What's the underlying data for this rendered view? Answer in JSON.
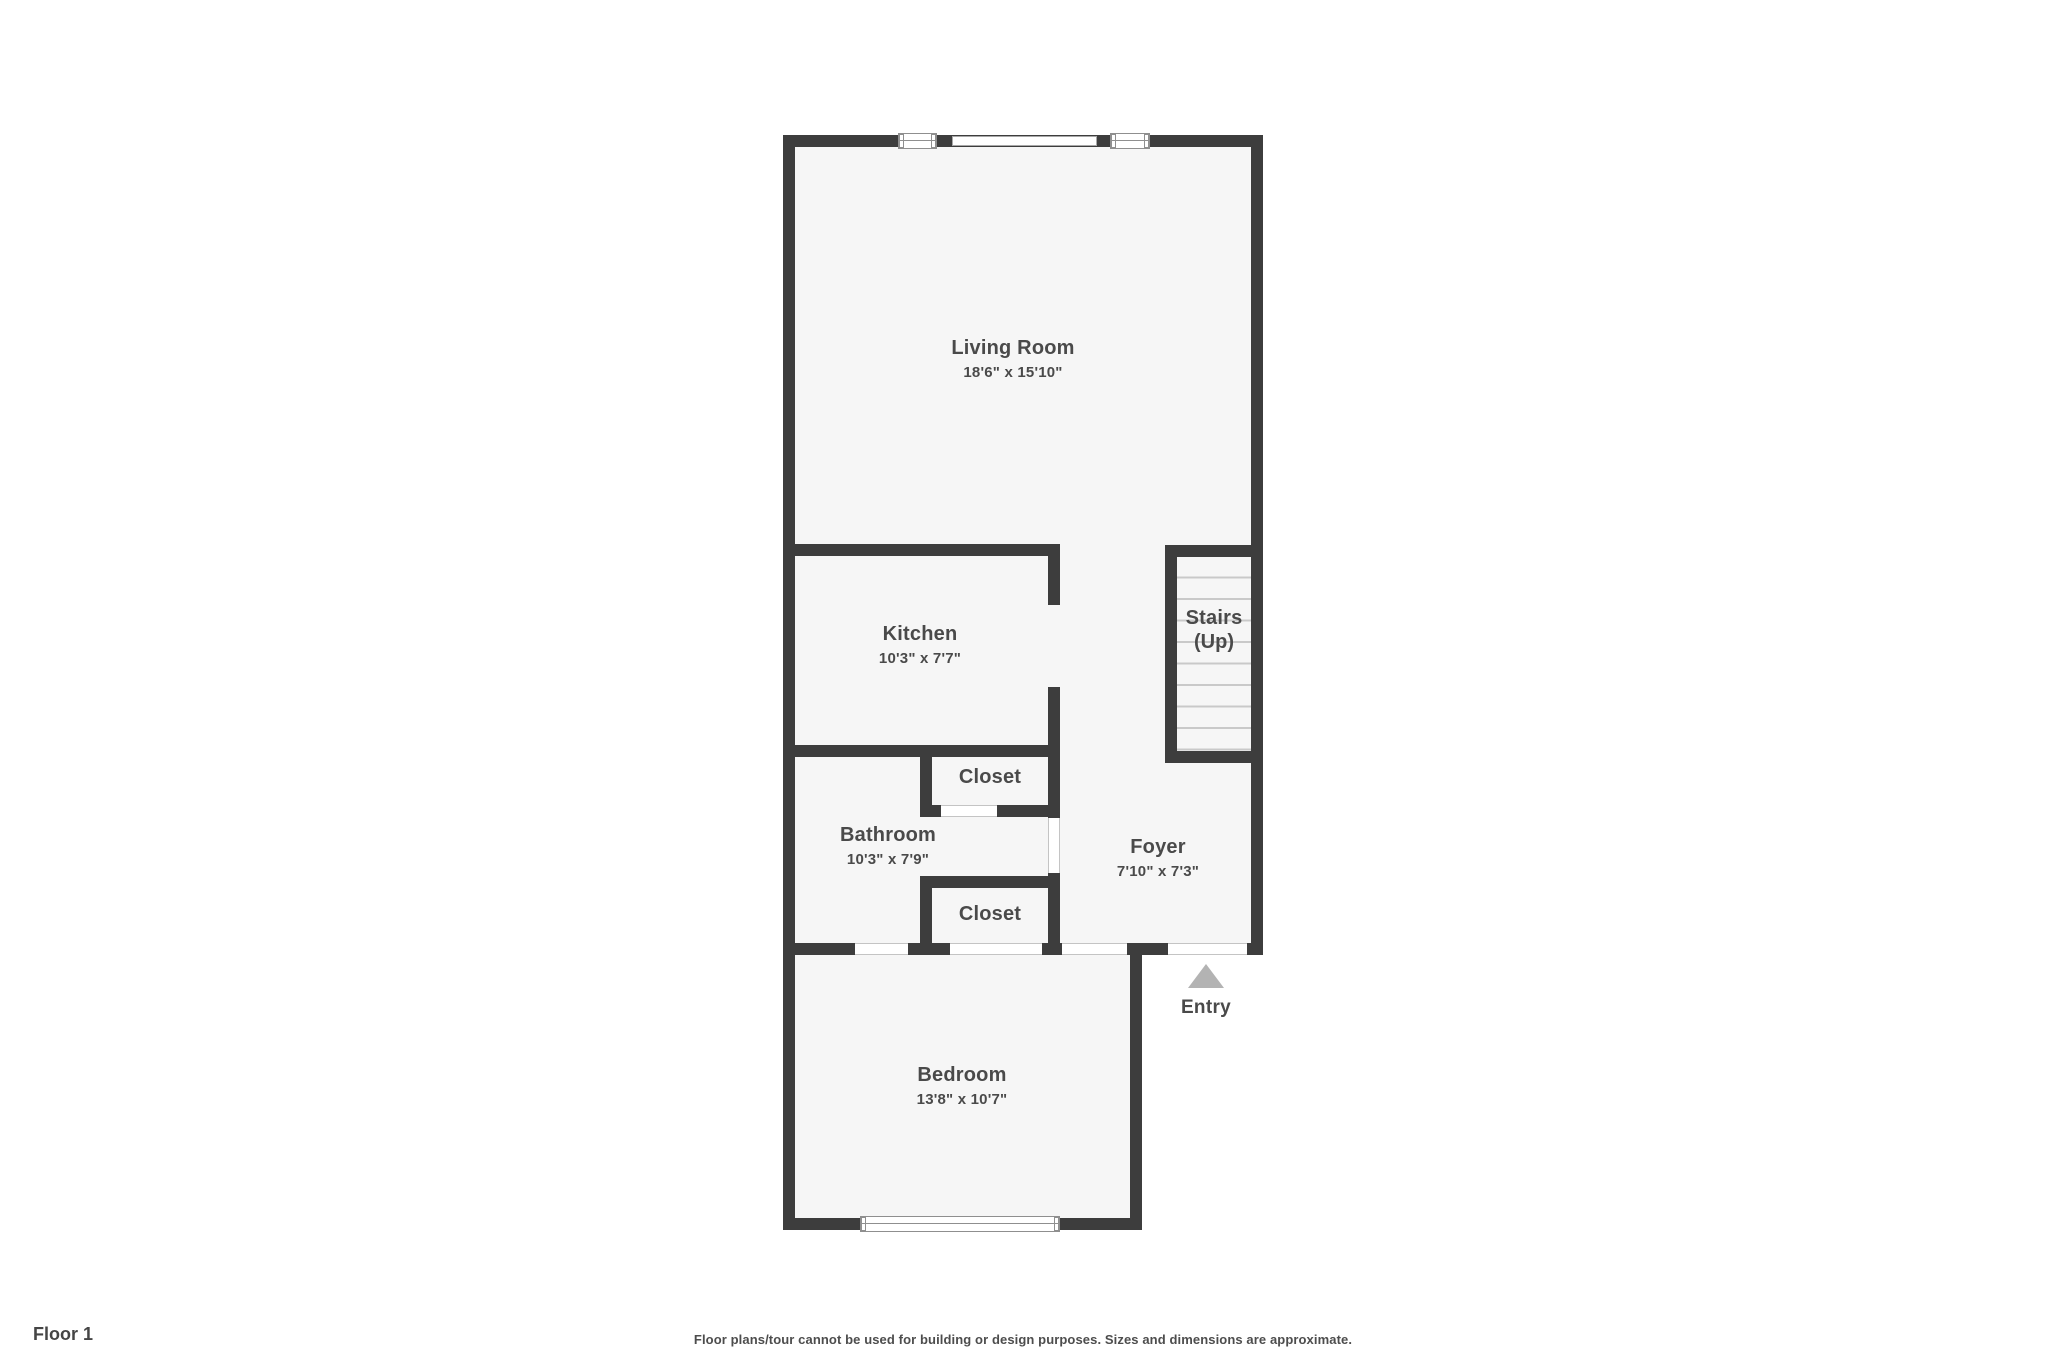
{
  "floor_plan": {
    "floor_label": "Floor 1",
    "disclaimer": "Floor plans/tour cannot be used for building or design purposes. Sizes and dimensions are approximate.",
    "entry_label": "Entry",
    "rooms": {
      "living_room": {
        "name": "Living Room",
        "dims": "18'6\" x 15'10\""
      },
      "kitchen": {
        "name": "Kitchen",
        "dims": "10'3\" x 7'7\""
      },
      "stairs": {
        "name": "Stairs",
        "direction": "(Up)"
      },
      "closet_upper": {
        "name": "Closet"
      },
      "bathroom": {
        "name": "Bathroom",
        "dims": "10'3\" x 7'9\""
      },
      "closet_lower": {
        "name": "Closet"
      },
      "foyer": {
        "name": "Foyer",
        "dims": "7'10\" x 7'3\""
      },
      "bedroom": {
        "name": "Bedroom",
        "dims": "13'8\" x 10'7\""
      }
    },
    "colors": {
      "wall": "#3d3d3d",
      "room_fill": "#f6f6f6",
      "label_text": "#4a4a4a",
      "entry_arrow": "#b3b3b3"
    }
  }
}
